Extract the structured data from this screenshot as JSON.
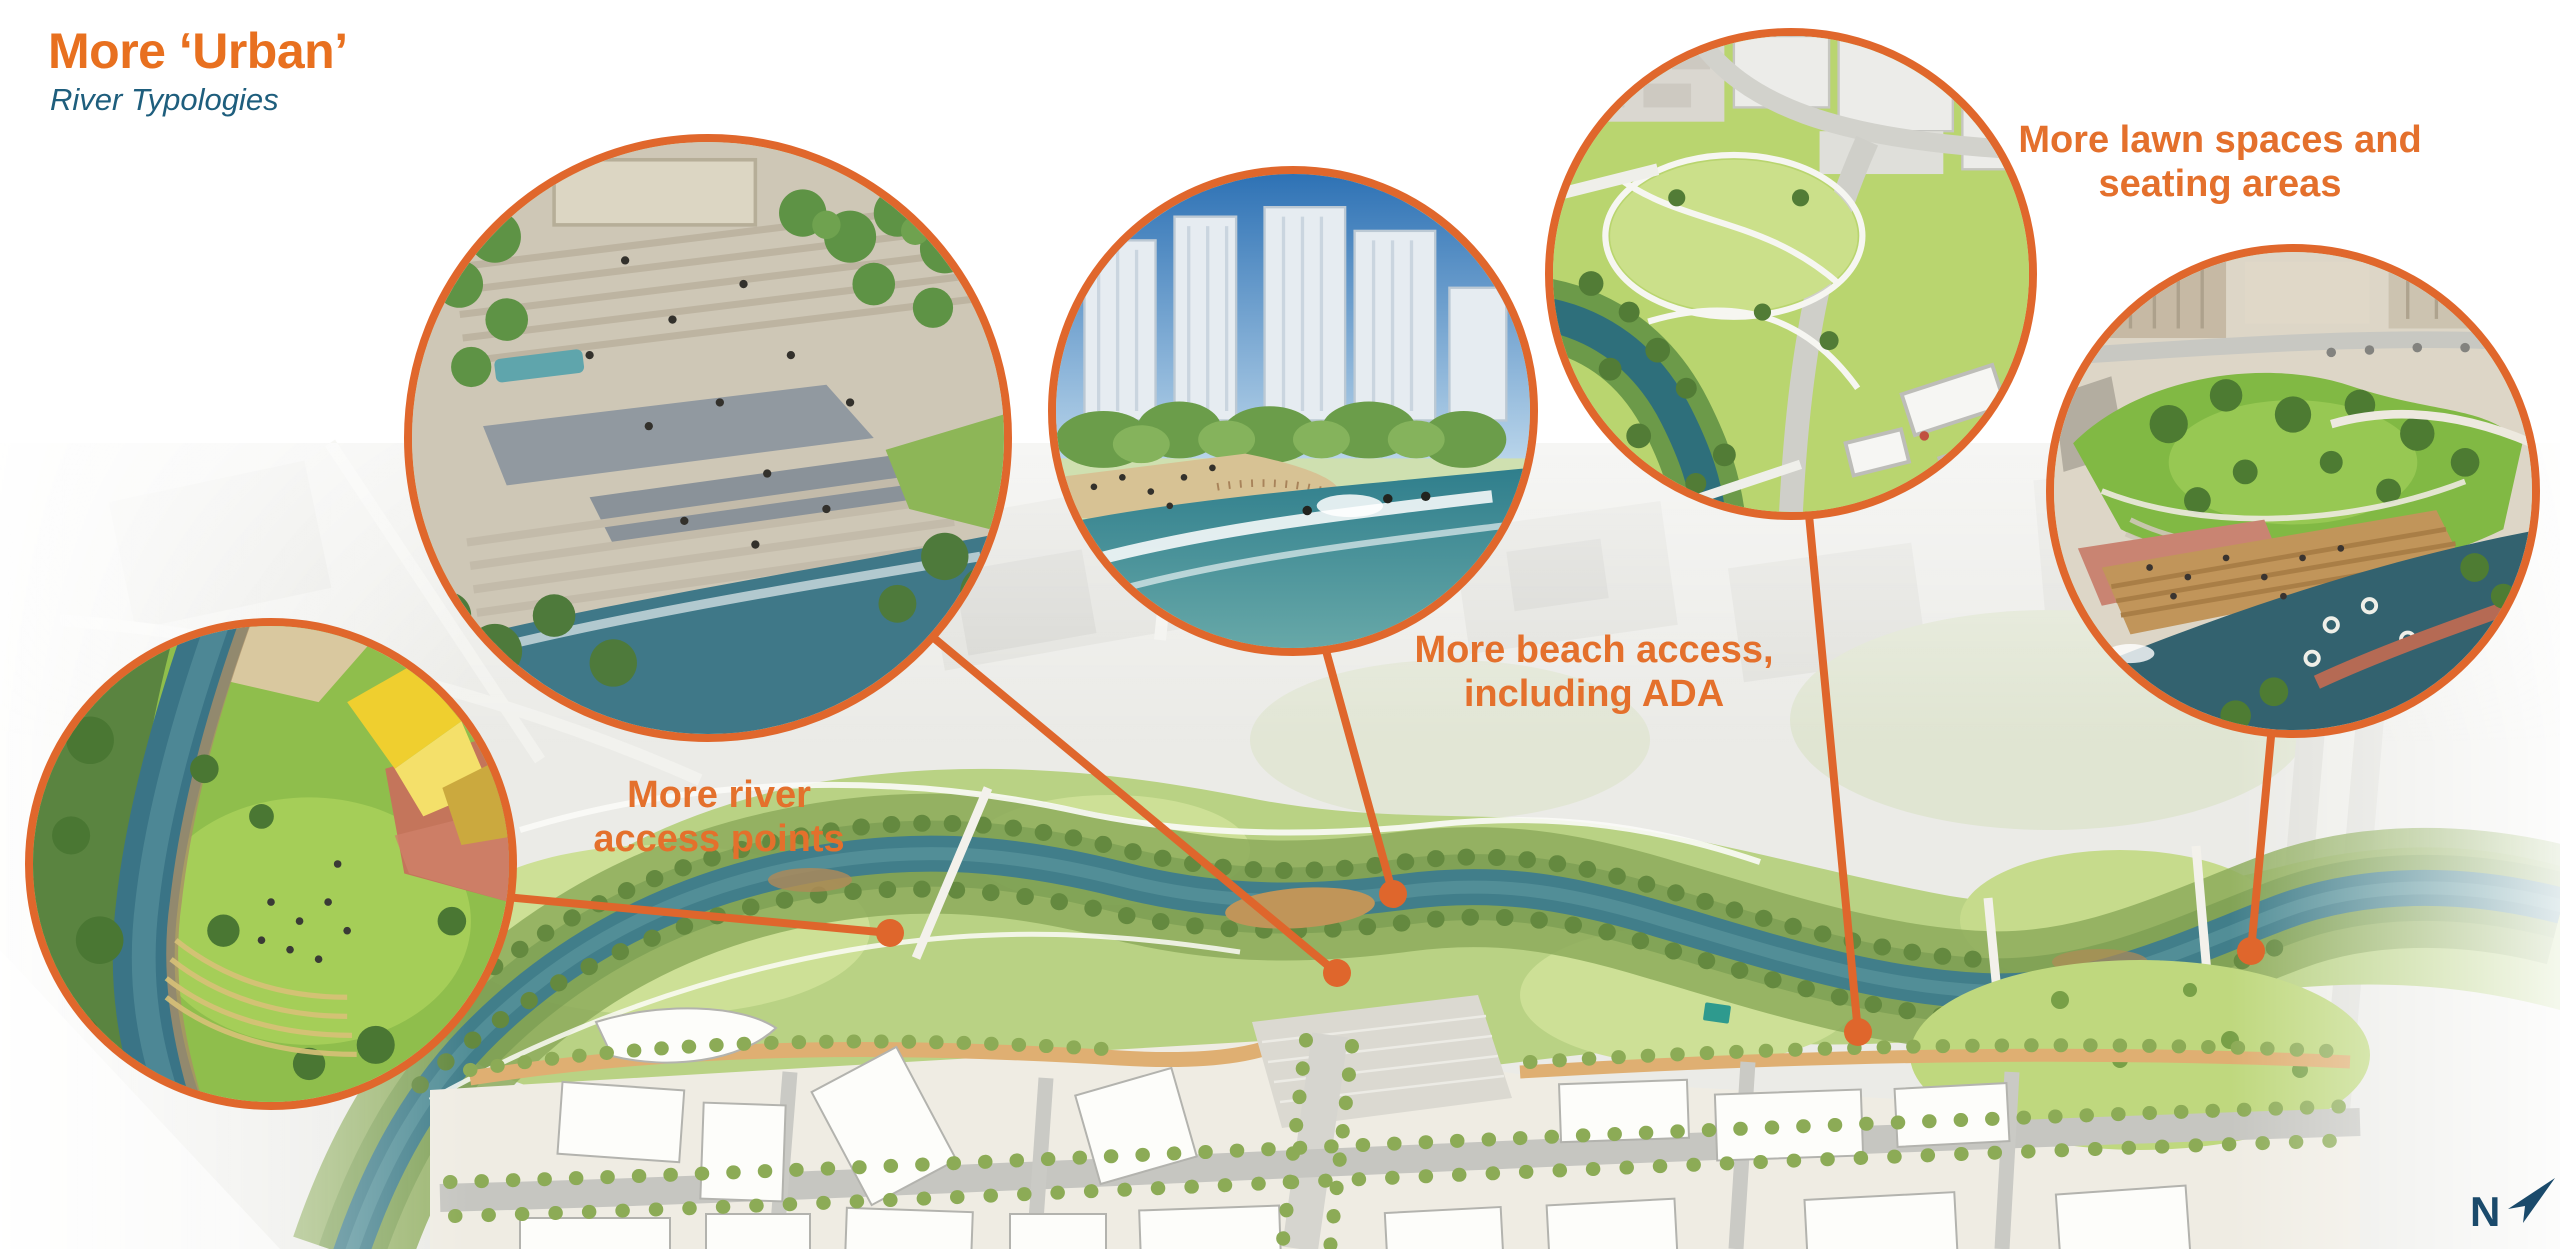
{
  "slide": {
    "title": "More ‘Urban’",
    "subtitle": "River Typologies",
    "north_label": "N"
  },
  "annotations": {
    "river_access": {
      "line1": "More river",
      "line2": "access points"
    },
    "beach_access": {
      "line1": "More beach access,",
      "line2": "including ADA"
    },
    "lawn_seating": {
      "line1": "More lawn spaces and",
      "line2": "seating areas"
    }
  },
  "callouts": {
    "riverfront_lawn": {
      "alt": "Aerial rendering: event lawn and yellow faceted pavilion beside the river"
    },
    "stepped_plaza": {
      "alt": "Rendering: terraced plaza steps leading down to the river"
    },
    "urban_beach": {
      "alt": "Rendering: downtown towers behind a river beach with surfers"
    },
    "neighborhood_park": {
      "alt": "Aerial rendering: park lawn and river below new towers"
    },
    "terraced_riverfront": {
      "alt": "Rendering: lawn hill and timber seating terraces along the river"
    }
  },
  "colors": {
    "accent_orange": "#E0672C",
    "title_orange": "#E8701F",
    "subtitle_blue": "#1E5E7D",
    "north_blue": "#1A4A6B"
  }
}
